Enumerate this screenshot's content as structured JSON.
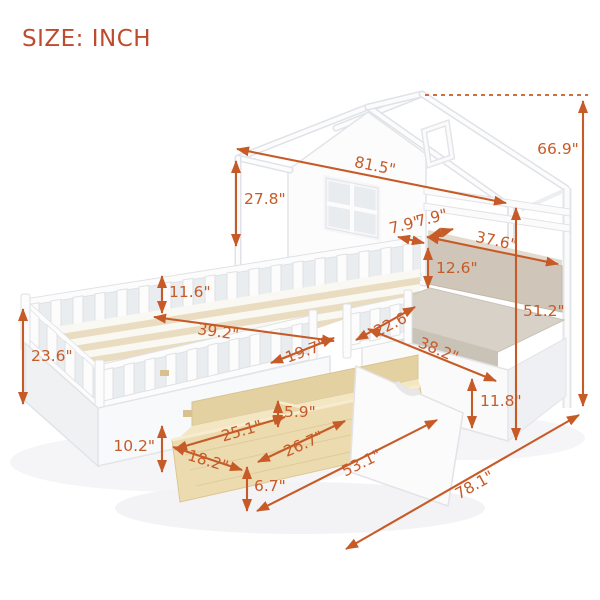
{
  "title": {
    "label": "SIZE: INCH"
  },
  "colors": {
    "dimension_accent": "#c75b28",
    "title_color": "#bf4b2e",
    "wood_fill": "#ecdaae",
    "cushion_fill": "#cfc5b8"
  },
  "illustration": {
    "subject": "white house-frame bed with guardrails, cushioned bench and pull-out storage drawers"
  },
  "dimensions": [
    {
      "id": "roof-length",
      "value": "81.5\""
    },
    {
      "id": "total-height",
      "value": "66.9\""
    },
    {
      "id": "wall-height",
      "value": "27.8\""
    },
    {
      "id": "top-gap-left",
      "value": "7.9\""
    },
    {
      "id": "top-gap-right",
      "value": "7.9\""
    },
    {
      "id": "shelf-width",
      "value": "37.6\""
    },
    {
      "id": "backrest-height",
      "value": "12.6\""
    },
    {
      "id": "bench-height",
      "value": "51.2\""
    },
    {
      "id": "guardrail-height",
      "value": "11.6\""
    },
    {
      "id": "bed-width",
      "value": "39.2\""
    },
    {
      "id": "seat-depth",
      "value": "22.6\""
    },
    {
      "id": "seat-width",
      "value": "38.2\""
    },
    {
      "id": "side-height",
      "value": "23.6\""
    },
    {
      "id": "rail-opening",
      "value": "19.7\""
    },
    {
      "id": "bench-base-height",
      "value": "11.8\""
    },
    {
      "id": "divider-height",
      "value": "5.9\""
    },
    {
      "id": "drawer-left-section",
      "value": "25.1\""
    },
    {
      "id": "drawer-right-section",
      "value": "26.7\""
    },
    {
      "id": "drawer-depth",
      "value": "18.2\""
    },
    {
      "id": "bed-base-height",
      "value": "10.2\""
    },
    {
      "id": "drawer-front-height",
      "value": "6.7\""
    },
    {
      "id": "drawer-length",
      "value": "53.1\""
    },
    {
      "id": "total-length",
      "value": "78.1\""
    }
  ]
}
